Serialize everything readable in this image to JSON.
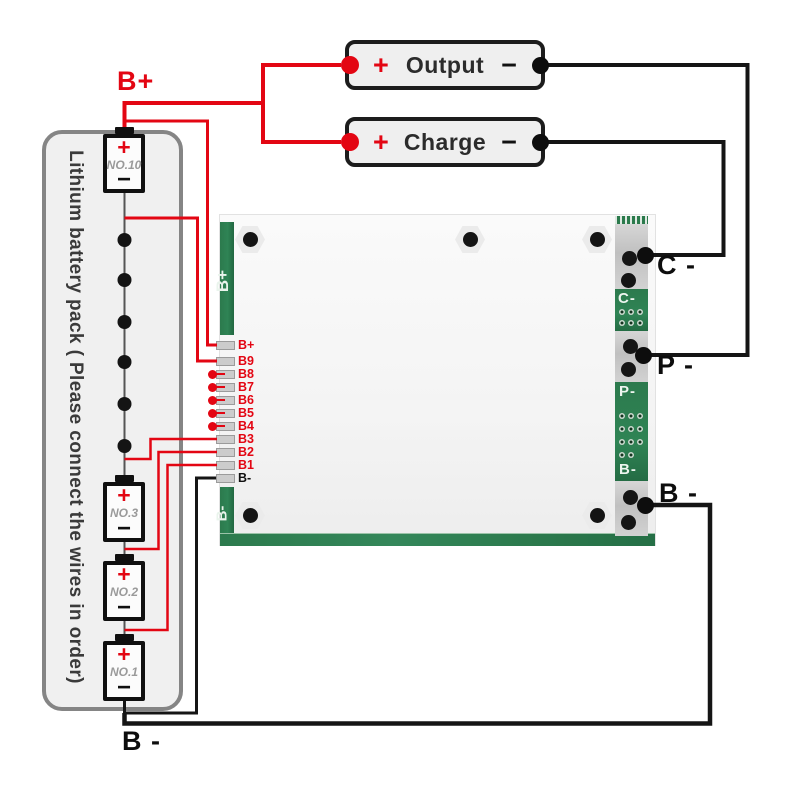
{
  "pack": {
    "caption": "Lithium battery pack ( Please connect the wires in order)",
    "cells": [
      {
        "label": "NO.10",
        "plus": "+",
        "minus": "−"
      },
      {
        "label": "NO.3",
        "plus": "+",
        "minus": "−"
      },
      {
        "label": "NO.2",
        "plus": "+",
        "minus": "−"
      },
      {
        "label": "NO.1",
        "plus": "+",
        "minus": "−"
      }
    ]
  },
  "connectors": [
    {
      "label": "Output",
      "plus": "+",
      "minus": "−"
    },
    {
      "label": "Charge",
      "plus": "+",
      "minus": "−"
    }
  ],
  "wire_labels": {
    "b_plus_top": "B+",
    "b_minus_bottom": "B -",
    "c_minus_right": "C -",
    "p_minus_right": "P -",
    "b_minus_right": "B -"
  },
  "pcb": {
    "silk_left_top": "B+",
    "silk_left_bottom": "B-",
    "silk_c": "C-",
    "silk_p": "P-",
    "silk_b": "B-",
    "pads": [
      {
        "label": "B+",
        "color": "red",
        "type": "wired"
      },
      {
        "label": "B9",
        "color": "red",
        "type": "wired"
      },
      {
        "label": "B8",
        "color": "red",
        "type": "stub"
      },
      {
        "label": "B7",
        "color": "red",
        "type": "stub"
      },
      {
        "label": "B6",
        "color": "red",
        "type": "stub"
      },
      {
        "label": "B5",
        "color": "red",
        "type": "stub"
      },
      {
        "label": "B4",
        "color": "red",
        "type": "stub"
      },
      {
        "label": "B3",
        "color": "red",
        "type": "wired"
      },
      {
        "label": "B2",
        "color": "red",
        "type": "wired"
      },
      {
        "label": "B1",
        "color": "red",
        "type": "wired"
      },
      {
        "label": "B-",
        "color": "black",
        "type": "wired"
      }
    ]
  },
  "colors": {
    "wire_red": "#e30613",
    "wire_black": "#151515",
    "pcb_green": "#2c7a4d",
    "pad_silver": "#cccccc"
  }
}
